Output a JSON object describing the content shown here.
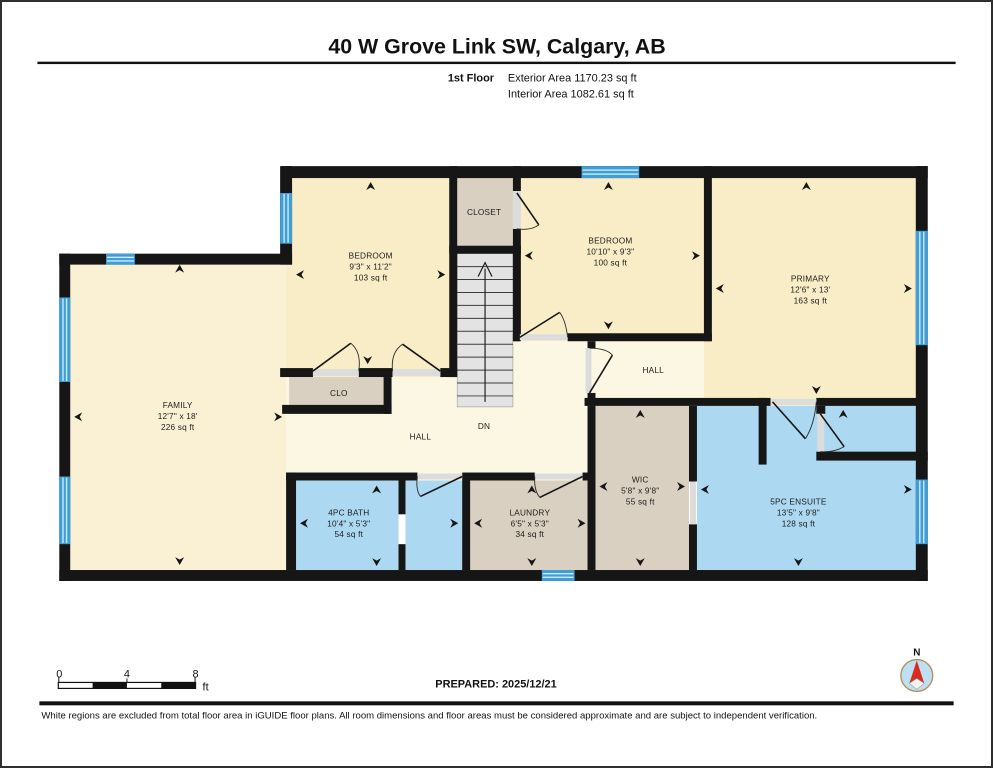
{
  "header": {
    "title": "40 W Grove Link SW, Calgary, AB",
    "floor_label": "1st Floor",
    "exterior_area": "Exterior Area 1170.23 sq ft",
    "interior_area": "Interior Area 1082.61 sq ft"
  },
  "rooms": {
    "family": {
      "name": "FAMILY",
      "dims": "12'7\" x 18'",
      "area": "226 sq ft"
    },
    "bedroom1": {
      "name": "BEDROOM",
      "dims": "9'3\" x 11'2\"",
      "area": "103 sq ft"
    },
    "closet": {
      "name": "CLOSET"
    },
    "bedroom2": {
      "name": "BEDROOM",
      "dims": "10'10\" x 9'3\"",
      "area": "100 sq ft"
    },
    "primary": {
      "name": "PRIMARY",
      "dims": "12'6\" x 13'",
      "area": "163 sq ft"
    },
    "clo": {
      "name": "CLO"
    },
    "hall_center": {
      "name": "HALL"
    },
    "hall_right": {
      "name": "HALL"
    },
    "stairs": {
      "name": "DN"
    },
    "bath": {
      "name": "4PC BATH",
      "dims": "10'4\" x 5'3\"",
      "area": "54 sq ft"
    },
    "laundry": {
      "name": "LAUNDRY",
      "dims": "6'5\" x 5'3\"",
      "area": "34 sq ft"
    },
    "wic": {
      "name": "WIC",
      "dims": "5'8\" x 9'8\"",
      "area": "55 sq ft"
    },
    "ensuite": {
      "name": "5PC ENSUITE",
      "dims": "13'5\" x 9'8\"",
      "area": "128 sq ft"
    }
  },
  "scale_bar": {
    "tick0": "0",
    "tick1": "4",
    "tick2": "8",
    "unit": "ft"
  },
  "compass": {
    "north_label": "N"
  },
  "footer": {
    "prepared": "PREPARED: 2025/12/21",
    "disclaimer": "White regions are excluded from total floor area in iGUIDE floor plans. All room dimensions and floor areas must be considered approximate and are subject to independent verification."
  },
  "colors": {
    "wall": "#161616",
    "room_cream": "#F8EDC6",
    "family_cream": "#FAF1D4",
    "hall_cream": "#FCF7E2",
    "closet_tan": "#D9D0C1",
    "bath_blue": "#ACD8F2",
    "window_blue": "#3E9FD8",
    "stairs_gray": "#E3E3E3",
    "door_opening_gray": "#DCDCDC",
    "compass_ring": "#B5905E",
    "compass_fill": "#BFE0F3",
    "compass_needle_red": "#D92B1F"
  }
}
